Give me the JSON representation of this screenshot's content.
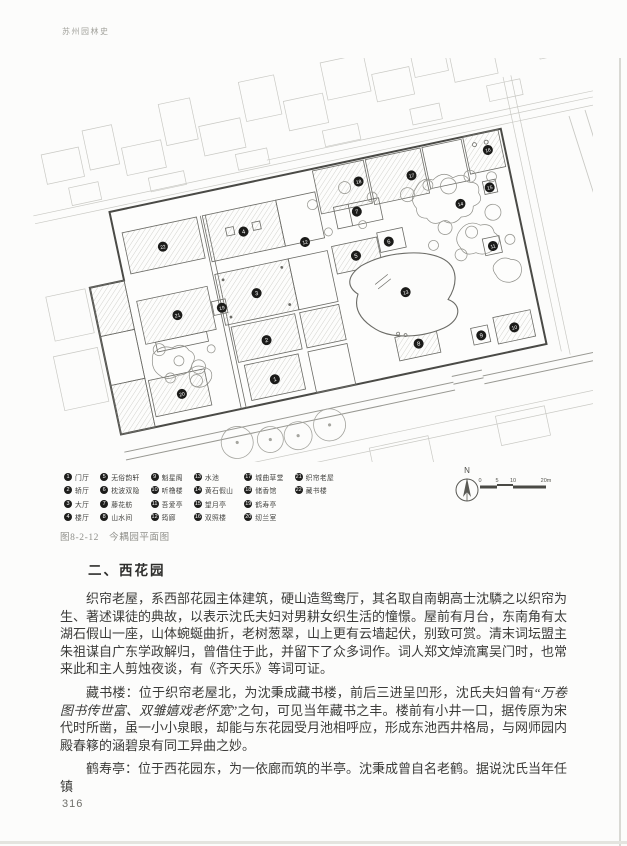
{
  "page": {
    "header": "苏州园林史",
    "page_number": "316"
  },
  "figure": {
    "caption": "图8-2-12　今耦园平面图",
    "north_label": "N",
    "scale_labels": [
      "0",
      "5",
      "10",
      "20m"
    ],
    "legend": {
      "items": [
        {
          "num": "1",
          "label": "门厅"
        },
        {
          "num": "2",
          "label": "轿厅"
        },
        {
          "num": "3",
          "label": "大厅"
        },
        {
          "num": "4",
          "label": "楼厅"
        },
        {
          "num": "5",
          "label": "无俗韵轩"
        },
        {
          "num": "6",
          "label": "枕波双隐"
        },
        {
          "num": "7",
          "label": "藤花舫"
        },
        {
          "num": "8",
          "label": "山水间"
        },
        {
          "num": "9",
          "label": "魁星阁"
        },
        {
          "num": "10",
          "label": "听橹楼"
        },
        {
          "num": "11",
          "label": "吾爱亭"
        },
        {
          "num": "12",
          "label": "筠廊"
        },
        {
          "num": "13",
          "label": "水池"
        },
        {
          "num": "14",
          "label": "黄石假山"
        },
        {
          "num": "15",
          "label": "望月亭"
        },
        {
          "num": "16",
          "label": "双照楼"
        },
        {
          "num": "17",
          "label": "城曲草堂"
        },
        {
          "num": "18",
          "label": "储香馆"
        },
        {
          "num": "19",
          "label": "鹤寿亭"
        },
        {
          "num": "20",
          "label": "纫兰室"
        },
        {
          "num": "21",
          "label": "织帘老屋"
        },
        {
          "num": "22",
          "label": "藏书楼"
        }
      ]
    }
  },
  "section": {
    "heading": "二、西花园",
    "paragraphs": {
      "p1": "织帘老屋，系西部花园主体建筑，硬山造鸳鸯厅，其名取自南朝高士沈驎之以织帘为生、著述课徒的典故，以表示沈氏夫妇对男耕女织生活的憧憬。屋前有月台，东南角有太湖石假山一座，山体蜿蜒曲折，老树葱翠，山上更有云墙起伏，别致可赏。清末词坛盟主朱祖谋自广东学政解归，曾借住于此，并留下了众多词作。词人郑文焯流寓吴门时，也常来此和主人剪烛夜谈，有《齐天乐》等词可证。",
      "p2_pre": "藏书楼：位于织帘老屋北，为沈秉成藏书楼，前后三进呈凹形，沈氏夫妇曾有“",
      "p2_quote": "万卷图书传世富、双雏嬉戏老怀宽",
      "p2_post": "”之句，可见当年藏书之丰。楼前有小井一口，据传原为宋代时所凿，虽一小小泉眼，却能与东花园受月池相呼应，形成东池西井格局，与网师园内殿春簃的涵碧泉有同工异曲之妙。",
      "p3": "鹤寿亭：位于西花园东，为一依廊而筑的半亭。沈秉成曾自名老鹤。据说沈氏当年任镇"
    }
  }
}
